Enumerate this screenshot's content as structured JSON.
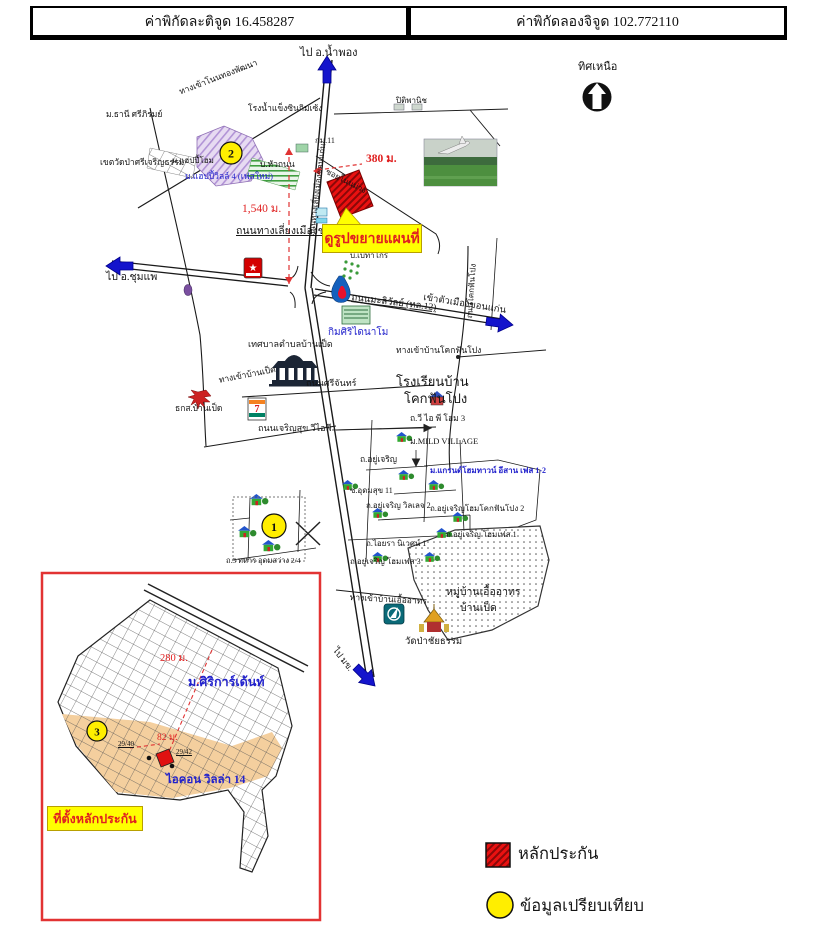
{
  "header": {
    "latitude": "ค่าพิกัดละติจูด 16.458287",
    "longitude": "ค่าพิกัดลองจิจูด 102.772110"
  },
  "compass": {
    "label": "ทิศเหนือ"
  },
  "overview": {
    "directions": {
      "north": "ไป อ.น้ำพอง",
      "west": "ไป อ.ชุมแพ",
      "east": "เข้าตัวเมืองขอนแก่น",
      "south": "ไป มข."
    },
    "measurements": {
      "site_to_road": "380 ม.",
      "site_to_interchange": "1,540 ม."
    },
    "roads": {
      "bypass": "ถนนทางเลี่ยงเมืองขอนแก่น (ทล.230)",
      "bypass_vertical": "ถนนทางเลี่ยงเมืองขอนแก่น",
      "maliwan": "ถนนมะลิวัลย์ (ทล.12)",
      "srichan": "ถนนศรีจันทร์",
      "charoensuk": "ถนนเจริญสุข วีไอพี",
      "non_muang": "ซอยโนนม่วง",
      "kokfanpong": "ถนนโคกฟันโปง",
      "entrance_nonthon": "ทางเข้าโนนทองพัฒนา",
      "entrance_banped": "ทางเข้าบ้านเป็ด",
      "entrance_kokfanpong": "ทางเข้าบ้านโคกฟันโปง",
      "entrance_euaarthorn": "ทางเข้าบ้านเอื้ออาทร",
      "km_marker": "กม.11",
      "thahan": "ถ.3 ทหาร อุดมสว่าง 2/4",
      "udomsuk": "ซ.อุดมสุข 11",
      "yucharoen": "ถ.อยู่เจริญ",
      "yucharoen_village2": "ถ.อยู่เจริญ วิลเลจ 2",
      "yucharoen_kokfanpong2": "ถ.อยู่เจริญโฮมโคกฟันโปง 2",
      "yucharoen_phase1": "ถ.อยู่เจริญ โฮมเฟส 1",
      "yucharoen_phase3": "ถ.อยู่เจริญ โฮมเฟส 3",
      "aiyara": "ถ.ไอยรา นิเวศน์ 1",
      "vip_home3": "ถ.วี ไอ พี โฮม 3"
    },
    "places": {
      "ice_factory": "โรงน้ำแข็งซินกิมเซ้ง",
      "petrol": "ปิติพานิช",
      "thani": "ม.ธานี ศรีภิรมย์",
      "wat_zone": "เขตวัดป่าศรีเจริญธรรม",
      "happy_home": "ม.แฮปปี้โฮม",
      "hua_thanon": "บ.หัวถนน",
      "happy_ville": "ม.แฮปปี้วิลล์ 4 (เฟสใหม่)",
      "betagro": "บ.เบทาโกร",
      "kimsiri": "กิมศิริไดนาโม",
      "municipality": "เทศบาลตำบลบ้านเป็ด",
      "tks": "ธกส.บ้านเป็ด",
      "school1": "โรงเรียนบ้าน",
      "school2": "โคกฟันโปง",
      "mild_village": "ม.MILD VILLAGE",
      "grand_home": "ม.แกรนด์โฮมทาวน์ อีสาน เฟส 1-2",
      "euaarthorn1": "หมู่บ้านเอื้ออาทร",
      "euaarthorn2": "บ้านเป็ด",
      "wat_pa": "วัดป่าชัยธรรม"
    },
    "callout": "ดูรูปขยายแผนที่"
  },
  "inset": {
    "measurements": {
      "road": "280 ม.",
      "side": "82 ม."
    },
    "houses": {
      "left": "29/40",
      "right": "29/42"
    },
    "siri_garden": "ม.ศิริการ์เด้นท์",
    "icon_villa": "ไอคอน วิลล่า 14",
    "callout": "ที่ตั้งหลักประกัน"
  },
  "markers": {
    "one": "1",
    "two": "2",
    "three": "3"
  },
  "legend": {
    "collateral": "หลักประกัน",
    "comparison": "ข้อมูลเปรียบเทียบ"
  },
  "brands": {
    "caltex_star": "★",
    "seven": "7"
  },
  "colors": {
    "arrow_blue": "#1414cc",
    "text_red": "#e02020",
    "text_blue": "#2222cc",
    "marker_yellow": "#ffee00",
    "callout_yellow": "#ffff00",
    "site_red": "#e01111",
    "block_tan": "#f4cf9e",
    "inset_border_red": "#e23333"
  }
}
